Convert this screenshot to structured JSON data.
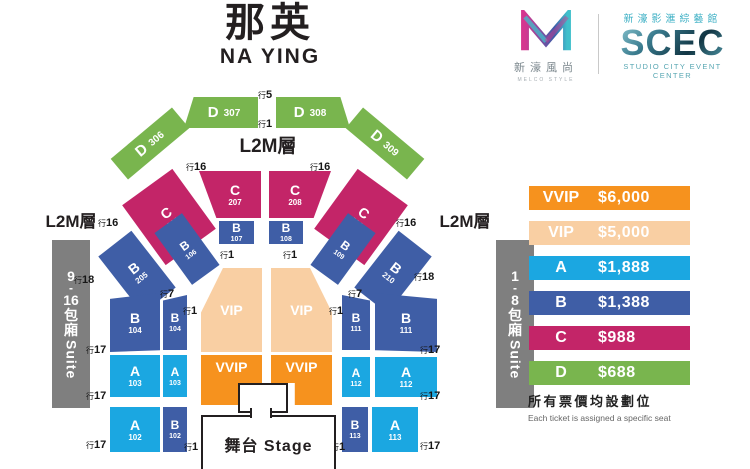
{
  "header": {
    "title_cn": "那英",
    "title_en": "NA YING"
  },
  "logos": {
    "melco": {
      "cn": "新濠風尚",
      "en": "MELCO STYLE"
    },
    "scec": {
      "cn": "新濠影滙綜藝館",
      "name": "SCEC",
      "en": "STUDIO CITY EVENT CENTER"
    }
  },
  "colors": {
    "A": "#1BA7E1",
    "B": "#3F5EA6",
    "C": "#C32568",
    "D": "#79B54E",
    "VIP": "#F9CFA3",
    "VVIP": "#F6921E",
    "suite": "#7F7F7F"
  },
  "map": {
    "level_label_top": "L2M層",
    "level_label_left": "L2M層",
    "level_label_right": "L2M層",
    "stage_label": "舞台 Stage",
    "suite_left": {
      "lines": [
        "9",
        "-",
        "16",
        "包",
        "廂"
      ],
      "word": "Suite"
    },
    "suite_right": {
      "lines": [
        "1",
        "-",
        "8",
        "包",
        "廂"
      ],
      "word": "Suite"
    },
    "sections": {
      "d306": {
        "cat": "D",
        "num": "306"
      },
      "d307": {
        "cat": "D",
        "num": "307"
      },
      "d308": {
        "cat": "D",
        "num": "308"
      },
      "d309": {
        "cat": "D",
        "num": "309"
      },
      "c206": {
        "cat": "C",
        "num": "206"
      },
      "c207": {
        "cat": "C",
        "num": "207"
      },
      "c208": {
        "cat": "C",
        "num": "208"
      },
      "c209": {
        "cat": "C",
        "num": "209"
      },
      "b205": {
        "cat": "B",
        "num": "205"
      },
      "b106": {
        "cat": "B",
        "num": "106"
      },
      "b107": {
        "cat": "B",
        "num": "107"
      },
      "b108": {
        "cat": "B",
        "num": "108"
      },
      "b109": {
        "cat": "B",
        "num": "109"
      },
      "b210": {
        "cat": "B",
        "num": "210"
      },
      "b104o": {
        "cat": "B",
        "num": "104"
      },
      "b104i": {
        "cat": "B",
        "num": "104"
      },
      "b111i": {
        "cat": "B",
        "num": "111"
      },
      "b111o": {
        "cat": "B",
        "num": "111"
      },
      "a103o": {
        "cat": "A",
        "num": "103"
      },
      "a103i": {
        "cat": "A",
        "num": "103"
      },
      "a112i": {
        "cat": "A",
        "num": "112"
      },
      "a112o": {
        "cat": "A",
        "num": "112"
      },
      "a102": {
        "cat": "A",
        "num": "102"
      },
      "b102": {
        "cat": "B",
        "num": "102"
      },
      "b113": {
        "cat": "B",
        "num": "113"
      },
      "a113": {
        "cat": "A",
        "num": "113"
      },
      "vipL": {
        "cat": "VIP"
      },
      "vipR": {
        "cat": "VIP"
      },
      "vvipL": {
        "cat": "VVIP"
      },
      "vvipR": {
        "cat": "VVIP"
      }
    },
    "row_labels": [
      {
        "p": "行",
        "n": "5"
      },
      {
        "p": "行",
        "n": "1"
      },
      {
        "p": "行",
        "n": "16"
      },
      {
        "p": "行",
        "n": "16"
      },
      {
        "p": "行",
        "n": "16"
      },
      {
        "p": "行",
        "n": "16"
      },
      {
        "p": "行",
        "n": "1"
      },
      {
        "p": "行",
        "n": "1"
      },
      {
        "p": "行",
        "n": "18"
      },
      {
        "p": "行",
        "n": "18"
      },
      {
        "p": "行",
        "n": "7"
      },
      {
        "p": "行",
        "n": "7"
      },
      {
        "p": "行",
        "n": "1"
      },
      {
        "p": "行",
        "n": "1"
      },
      {
        "p": "行",
        "n": "17"
      },
      {
        "p": "行",
        "n": "17"
      },
      {
        "p": "行",
        "n": "17"
      },
      {
        "p": "行",
        "n": "17"
      },
      {
        "p": "行",
        "n": "17"
      },
      {
        "p": "行",
        "n": "17"
      },
      {
        "p": "行",
        "n": "1"
      },
      {
        "p": "行",
        "n": "1"
      }
    ]
  },
  "legend": {
    "rows": [
      {
        "label": "VVIP",
        "price": "$6,000",
        "color_key": "VVIP"
      },
      {
        "label": "VIP",
        "price": "$5,000",
        "color_key": "VIP"
      },
      {
        "label": "A",
        "price": "$1,888",
        "color_key": "A"
      },
      {
        "label": "B",
        "price": "$1,388",
        "color_key": "B"
      },
      {
        "label": "C",
        "price": "$988",
        "color_key": "C"
      },
      {
        "label": "D",
        "price": "$688",
        "color_key": "D"
      }
    ]
  },
  "notes": {
    "cn": "所有票價均設劃位",
    "en": "Each ticket is assigned a specific seat"
  }
}
